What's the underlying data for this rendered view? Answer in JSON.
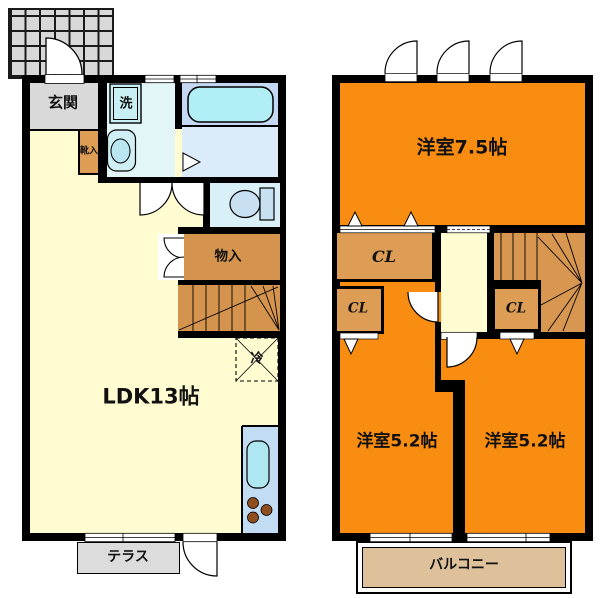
{
  "floor1": {
    "genkan_label": "玄関",
    "shoe_label": "靴入",
    "washer_label": "洗",
    "storage_label": "物入",
    "fridge_label": "冷",
    "ldk_label": "LDK13帖",
    "terrace_label": "テラス"
  },
  "floor2": {
    "bedroom75_label": "洋室7.5帖",
    "closet_wide_label": "CL",
    "closet_left_label": "CL",
    "closet_right_label": "CL",
    "bedroom52_left_label": "洋室5.2帖",
    "bedroom52_right_label": "洋室5.2帖",
    "balcony_label": "バルコニー"
  },
  "colors": {
    "room_orange": "#F98D12",
    "closet_brown": "#DD9D55",
    "stairs_brown_1f": "#D4944E",
    "stairs_brown_2f": "#D79750",
    "ldk_cream": "#FFFCD2",
    "genkan_gray": "#D9D9D9",
    "porch_gray": "#D8D8D8",
    "terrace_gray": "#DCDCDC",
    "balcony_tan": "#DEC19B",
    "washroom_cyan": "#E3F6F7",
    "bath_blue_upper": "#C6D9F4",
    "bath_blue_lower": "#DCEBFA",
    "tub_cyan": "#B2EEF6",
    "toilet_blue": "#DAF0F8",
    "kitchen_blue": "#C2DCF4",
    "wall_black": "#000000"
  }
}
